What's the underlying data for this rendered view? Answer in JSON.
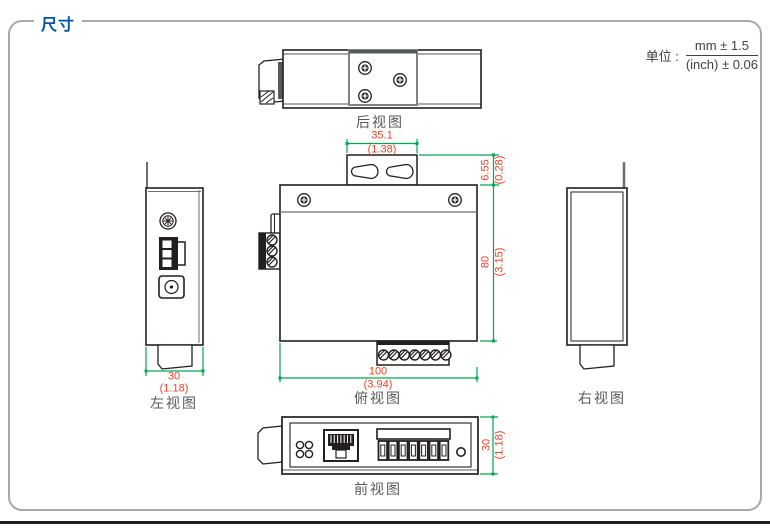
{
  "header": {
    "title": "尺寸"
  },
  "units": {
    "label": "单位 :",
    "mm": "mm ± 1.5",
    "inch": "(inch) ± 0.06"
  },
  "views": {
    "rear": {
      "label": "后视图"
    },
    "top": {
      "label": "俯视图"
    },
    "left": {
      "label": "左视图"
    },
    "right": {
      "label": "右视图"
    },
    "front": {
      "label": "前视图"
    }
  },
  "dimensions": {
    "mount_tab_width": {
      "mm": "35.1",
      "inch": "(1.38)"
    },
    "mount_tab_depth": {
      "mm": "6.55",
      "inch": "(0.28)"
    },
    "body_depth": {
      "mm": "80",
      "inch": "(3.15)"
    },
    "body_width": {
      "mm": "100",
      "inch": "(3.94)"
    },
    "side_width": {
      "mm": "30",
      "inch": "(1.18)"
    },
    "front_height": {
      "mm": "30",
      "inch": "(1.18)"
    }
  },
  "colors": {
    "accent_blue": "#0054a6",
    "dimension_text": "#ef4123",
    "dimension_line": "#00a651",
    "outline": "#231f20",
    "label_gray": "#58595b"
  }
}
